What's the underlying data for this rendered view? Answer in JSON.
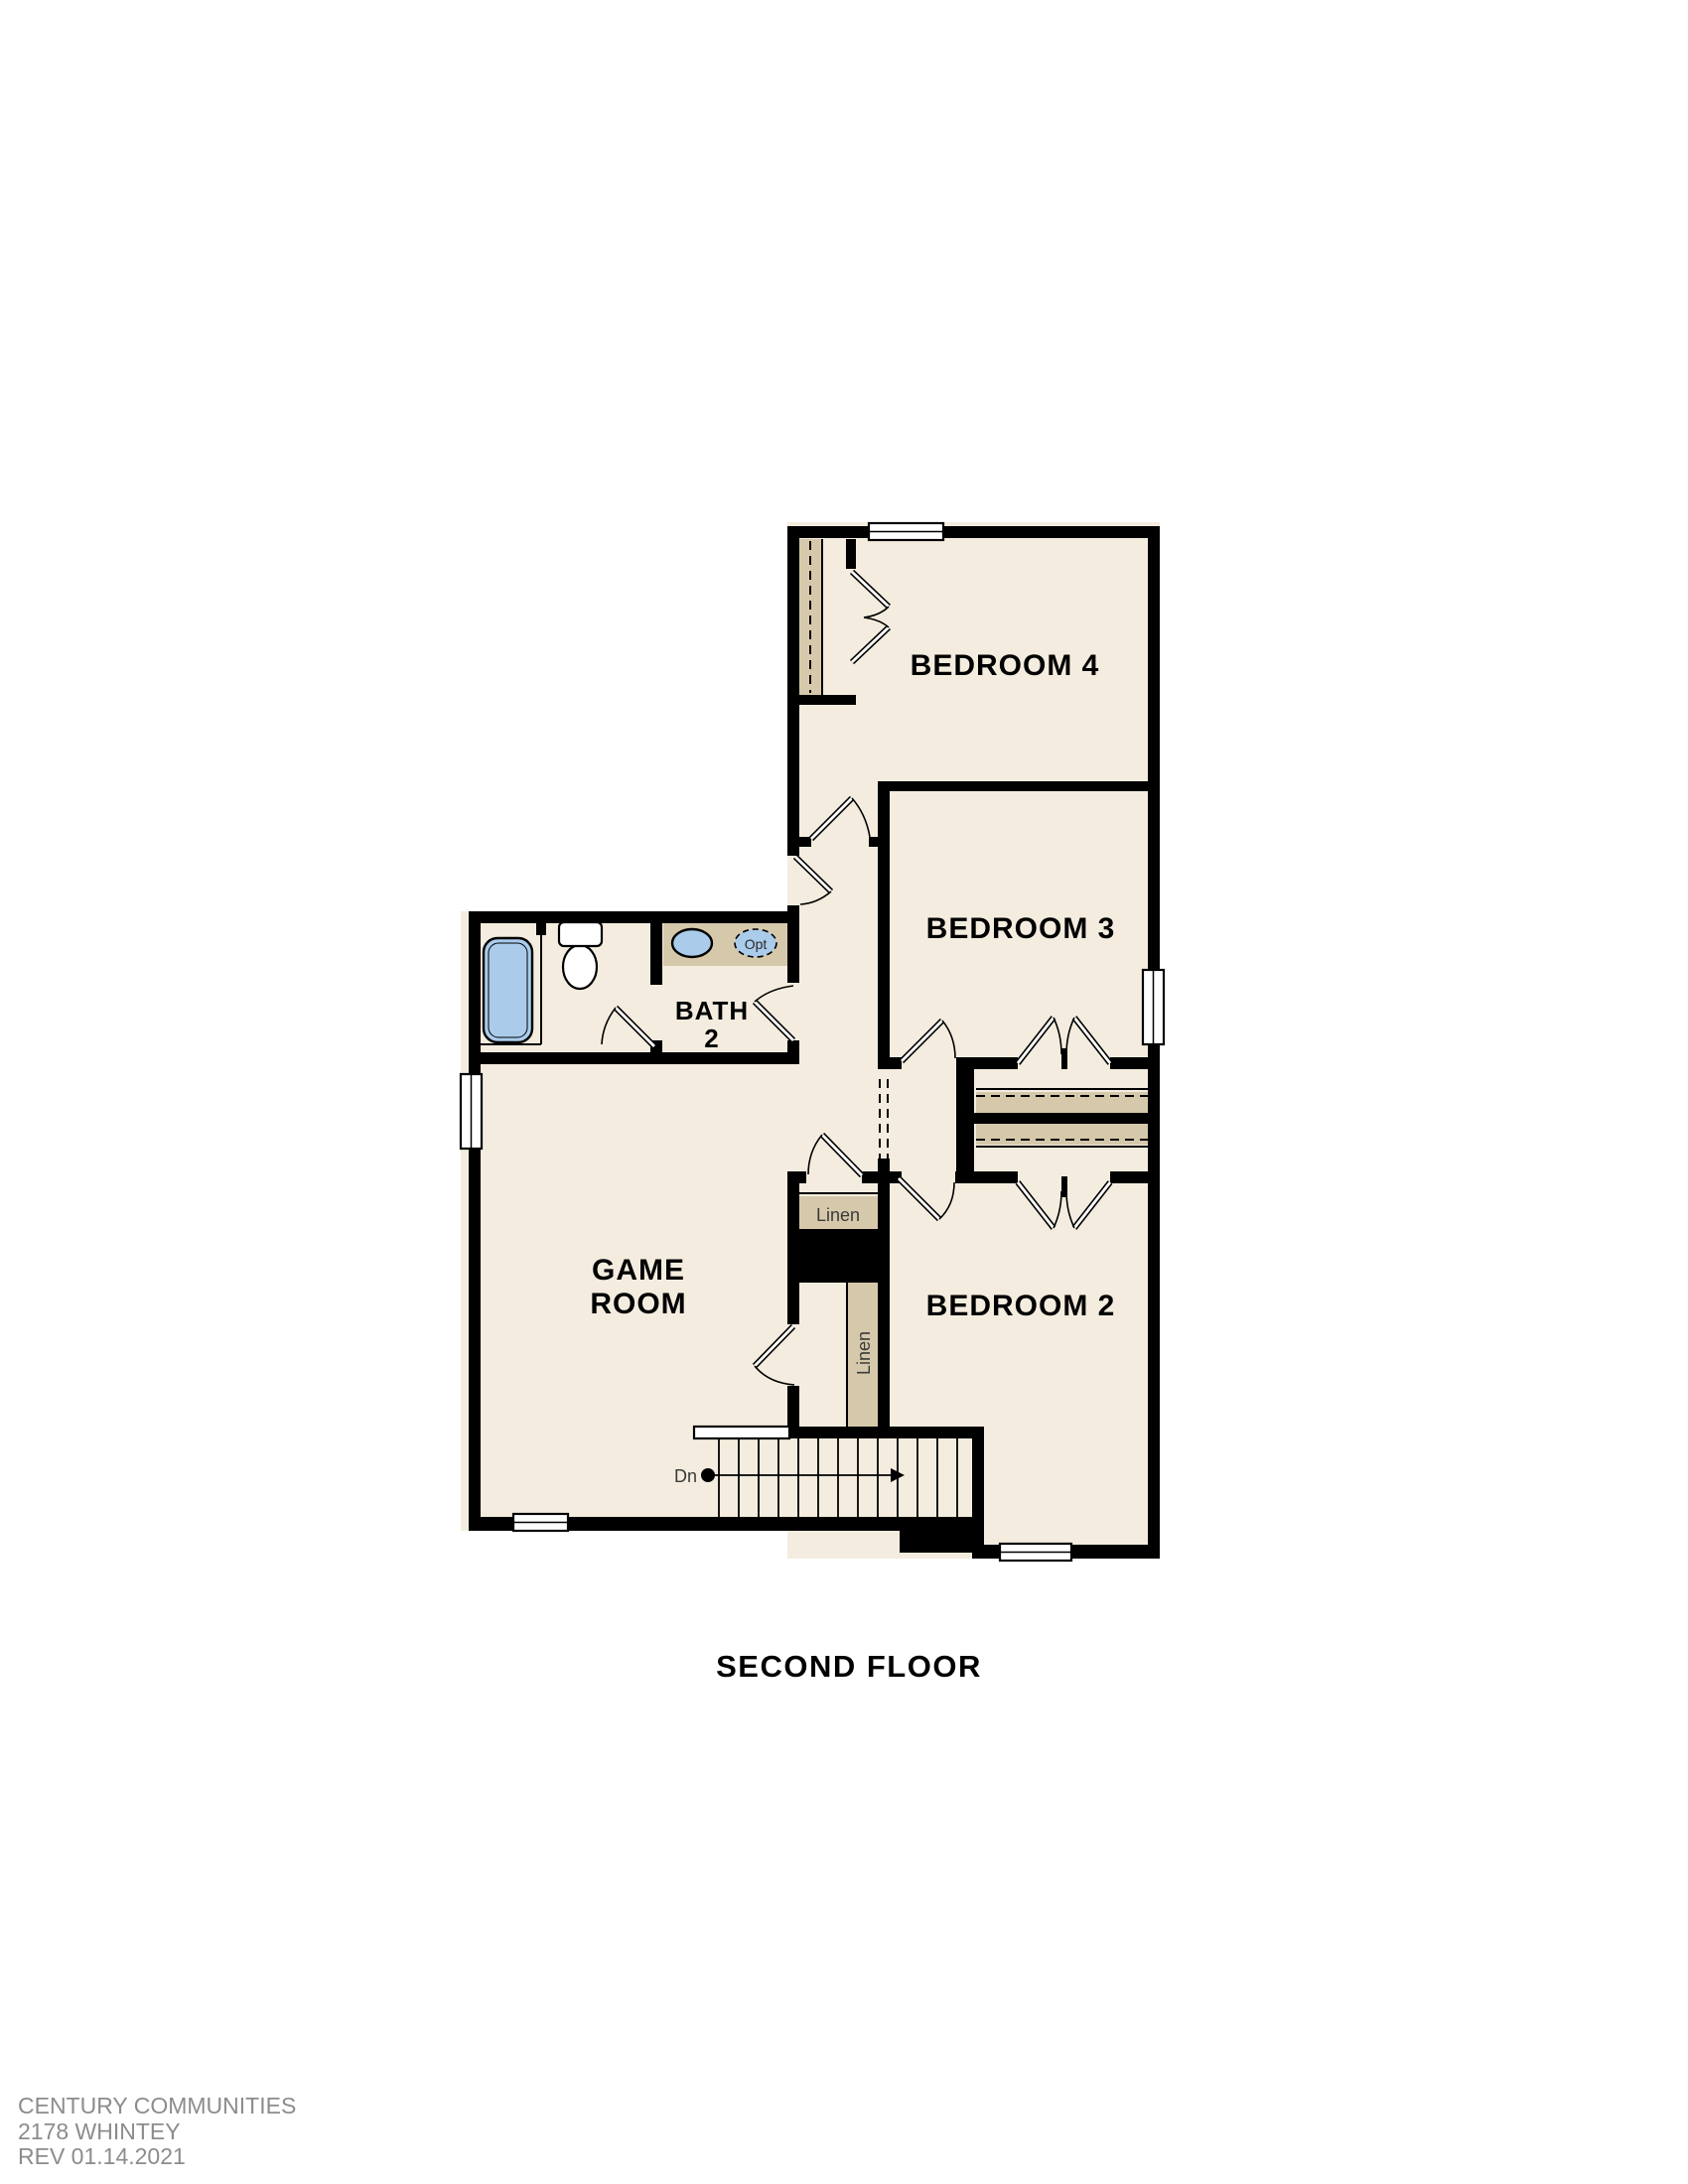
{
  "title": "SECOND FLOOR",
  "rooms": {
    "bedroom4": "BEDROOM 4",
    "bedroom3": "BEDROOM 3",
    "bedroom2": "BEDROOM 2",
    "bath_line1": "BATH",
    "bath_line2": "2",
    "game_line1": "GAME",
    "game_line2": "ROOM",
    "linen_upper": "Linen",
    "linen_lower": "Linen",
    "stairs_down": "Dn",
    "optional_sink": "Opt"
  },
  "footer": {
    "line1": "CENTURY COMMUNITIES",
    "line2": "2178 WHINTEY",
    "line3": "REV 01.14.2021"
  },
  "colors": {
    "wall": "#000000",
    "cream": "#f4eddf",
    "tan": "#d6c9ab",
    "blue": "#aacbea",
    "gray": "#8c8c8c"
  }
}
